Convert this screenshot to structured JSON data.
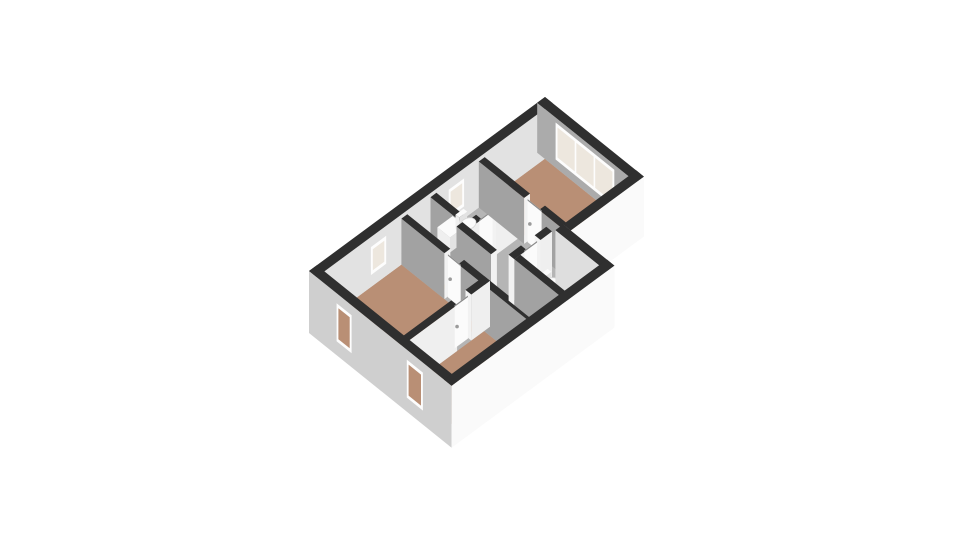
{
  "meta": {
    "description": "3D isometric floor plan of an upper storey with three brown-floored rooms, a bathroom, hallway, WC and staircase",
    "background": "#ffffff"
  },
  "palette": {
    "wall_top": "#2f2f2f",
    "interior_face_se": "#efefef",
    "interior_face_sw": "#a2a2a2",
    "nw_interior_face": "#e2e2e2",
    "ne_interior_face": "#ababab",
    "exterior_face_sw": "#cfcfcf",
    "exterior_face_se": "#fafafa",
    "cap_face": "#f2f2f2",
    "floor_gray": "#b5b5b5",
    "floor_brown": "#b98f75",
    "window_frame": "#fdfdfd",
    "window_pane": "#ede7de",
    "window_pane_exterior": "#b98f75",
    "door_leaf": "#fbfbfb",
    "door_top": "#8a8a8a",
    "door_handle": "#9b9b9b",
    "stairs": "#dfa04e",
    "stairs_step": "#f2c684",
    "fixture_top": "#fbfbfb",
    "fixture_front": "#e3e3e3",
    "fixture_side": "#efefef"
  },
  "scene": {
    "projection": {
      "origin": [
        309,
        321
      ],
      "axisU": [
        23.6,
        -17.4
      ],
      "axisV": [
        23.0,
        18.5
      ]
    },
    "elements": [
      {
        "t": "floor",
        "name": "floor-base-gray",
        "fill": "#b5b5b5",
        "pts": [
          [
            0.33,
            0.33
          ],
          [
            9.67,
            0.33
          ],
          [
            9.67,
            3.97
          ],
          [
            6.57,
            3.97
          ],
          [
            6.57,
            5.87
          ],
          [
            0.33,
            5.87
          ]
        ]
      },
      {
        "t": "floor",
        "name": "floor-bedroom-right",
        "fill": "#b98f75",
        "pts": [
          [
            7.125,
            0.33
          ],
          [
            9.67,
            0.33
          ],
          [
            9.67,
            3.97
          ],
          [
            7.125,
            3.97
          ]
        ]
      },
      {
        "t": "floor",
        "name": "floor-room-left",
        "fill": "#b98f75",
        "pts": [
          [
            0.33,
            0.33
          ],
          [
            3.595,
            0.33
          ],
          [
            3.595,
            3.675
          ],
          [
            0.33,
            3.675
          ]
        ]
      },
      {
        "t": "floor",
        "name": "floor-room-bottom",
        "fill": "#b98f75",
        "pts": [
          [
            0.33,
            3.925
          ],
          [
            3.595,
            3.925
          ],
          [
            3.595,
            5.87
          ],
          [
            0.33,
            5.87
          ]
        ]
      },
      {
        "t": "stairs",
        "name": "staircase",
        "u1": 3.95,
        "u2": 4.55,
        "v1": 1.7,
        "v2": 3.2,
        "z": -3,
        "steps": 6,
        "fill": "#dfa04e",
        "stepFill": "#f2c684"
      },
      {
        "t": "wall",
        "name": "wall-exterior-nw",
        "axis": "u",
        "pos": 0.165,
        "th": 0.33,
        "from": 0,
        "to": 10,
        "h": 50,
        "zb": 0,
        "face": "#e2e2e2",
        "cap": false
      },
      {
        "t": "window",
        "name": "window-nw-left-room",
        "axis": "u",
        "pos": 0.33,
        "a": 2.3,
        "b": 2.95,
        "z1": 12,
        "z2": 40,
        "panes": 1,
        "pane": "#ede7de"
      },
      {
        "t": "window",
        "name": "window-nw-bathroom",
        "axis": "u",
        "pos": 0.33,
        "a": 5.6,
        "b": 6.25,
        "z1": 12,
        "z2": 40,
        "panes": 1,
        "pane": "#ede7de"
      },
      {
        "t": "wall",
        "name": "wall-exterior-ne",
        "axis": "v",
        "pos": 9.835,
        "th": 0.33,
        "from": 0,
        "to": 4.3,
        "h": 50,
        "zb": 0,
        "face": "#ababab",
        "cap": true
      },
      {
        "t": "window",
        "name": "window-ne-triple",
        "axis": "v",
        "pos": 9.67,
        "a": 0.8,
        "b": 3.35,
        "z1": 8,
        "z2": 45,
        "panes": 3,
        "pane": "#ede7de"
      },
      {
        "t": "wall",
        "name": "wall-bathroom-west",
        "axis": "v",
        "pos": 4.95,
        "th": 0.25,
        "from": 0.33,
        "to": 2.025,
        "h": 46,
        "face": "#a2a2a2",
        "cap": true
      },
      {
        "t": "wall",
        "name": "wall-bathroom-south",
        "axis": "u",
        "pos": 1.9,
        "th": 0.25,
        "from": 4.825,
        "to": 6.875,
        "h": 46,
        "face": "#efefef",
        "cap": true,
        "gaps": [
          [
            5.35,
            5.95
          ]
        ]
      },
      {
        "t": "door",
        "name": "door-bathroom",
        "axis": "u",
        "pos": 1.9,
        "a": 5.37,
        "b": 5.93,
        "h": 43
      },
      {
        "t": "box",
        "name": "sink-vanity",
        "u1": 5.0,
        "u2": 5.65,
        "v1": 0.45,
        "v2": 1.0,
        "h": 15
      },
      {
        "t": "box",
        "name": "toilet-tank-bathroom",
        "u1": 5.78,
        "u2": 6.12,
        "v1": 0.44,
        "v2": 0.6,
        "h": 14
      },
      {
        "t": "bowl",
        "name": "toilet-bathroom",
        "cu": 5.95,
        "cv": 0.82,
        "r": 0.26,
        "z": 9
      },
      {
        "t": "wall",
        "name": "wall-bedroom-right-west",
        "axis": "v",
        "pos": 7.0,
        "th": 0.25,
        "from": 0.33,
        "to": 3.97,
        "h": 46,
        "face": "#a2a2a2",
        "cap": true,
        "gaps": [
          [
            2.3,
            2.95
          ]
        ]
      },
      {
        "t": "door",
        "name": "door-bedroom-right",
        "axis": "v",
        "pos": 7.0,
        "a": 2.32,
        "b": 2.93,
        "h": 43
      },
      {
        "t": "wall",
        "name": "wall-exterior-se-upper",
        "axis": "u",
        "pos": 4.135,
        "th": 0.33,
        "from": 6.9,
        "to": 10,
        "h": 50,
        "zb": -10,
        "face": "#fafafa",
        "cap": true
      },
      {
        "t": "wall",
        "name": "wall-stairwell",
        "axis": "v",
        "pos": 4.72,
        "th": 0.25,
        "from": 1.7,
        "to": 3.2,
        "h": 46,
        "face": "#a2a2a2",
        "cap": true
      },
      {
        "t": "wall",
        "name": "wall-hall-west",
        "axis": "v",
        "pos": 3.72,
        "th": 0.25,
        "from": 0.33,
        "to": 5.87,
        "h": 46,
        "face": "#a2a2a2",
        "cap": true,
        "gaps": [
          [
            2.2,
            2.8
          ]
        ]
      },
      {
        "t": "door",
        "name": "door-hall",
        "axis": "v",
        "pos": 3.72,
        "a": 2.22,
        "b": 2.78,
        "h": 43
      },
      {
        "t": "wall",
        "name": "wall-wc-north",
        "axis": "u",
        "pos": 3.7,
        "th": 0.25,
        "from": 4.975,
        "to": 6.57,
        "h": 46,
        "face": "#efefef",
        "cap": true,
        "gaps": [
          [
            5.5,
            6.08
          ]
        ]
      },
      {
        "t": "door",
        "name": "door-wc",
        "axis": "u",
        "pos": 3.7,
        "a": 5.52,
        "b": 6.06,
        "h": 43
      },
      {
        "t": "box",
        "name": "toilet-tank-wc",
        "u1": 5.98,
        "u2": 6.35,
        "v1": 3.86,
        "v2": 4.02,
        "h": 13
      },
      {
        "t": "bowl",
        "name": "toilet-wc",
        "cu": 6.15,
        "cv": 4.22,
        "r": 0.24,
        "z": 9
      },
      {
        "t": "wall",
        "name": "wall-exterior-ne-lower",
        "axis": "v",
        "pos": 6.735,
        "th": 0.33,
        "from": 3.97,
        "to": 6.2,
        "h": 50,
        "zb": -10,
        "face": "#dedede",
        "cap": true
      },
      {
        "t": "wall",
        "name": "wall-wc-west",
        "axis": "v",
        "pos": 5.1,
        "th": 0.25,
        "from": 3.825,
        "to": 5.87,
        "h": 46,
        "face": "#a2a2a2",
        "cap": true
      },
      {
        "t": "wall",
        "name": "wall-rooms-divider",
        "axis": "u",
        "pos": 3.8,
        "th": 0.25,
        "from": 0.33,
        "to": 3.845,
        "h": 46,
        "face": "#efefef",
        "cap": true,
        "gaps": [
          [
            2.45,
            3.05
          ]
        ]
      },
      {
        "t": "door",
        "name": "door-room-bottom",
        "axis": "u",
        "pos": 3.8,
        "a": 2.47,
        "b": 3.03,
        "h": 43
      },
      {
        "t": "wall",
        "name": "wall-exterior-sw",
        "axis": "v",
        "pos": 0.165,
        "th": 0.33,
        "from": 0,
        "to": 6.2,
        "h": 50,
        "zb": -12,
        "face": "#cfcfcf",
        "cap": false
      },
      {
        "t": "window",
        "name": "window-sw-left-room",
        "axis": "v",
        "pos": 0,
        "a": 1.2,
        "b": 1.85,
        "z1": 2,
        "z2": 40,
        "panes": 1,
        "pane": "#b98f75"
      },
      {
        "t": "window",
        "name": "window-sw-bottom-room",
        "axis": "v",
        "pos": 0,
        "a": 4.25,
        "b": 4.95,
        "z1": 2,
        "z2": 40,
        "panes": 1,
        "pane": "#b98f75"
      },
      {
        "t": "wall",
        "name": "wall-exterior-se-lower",
        "axis": "u",
        "pos": 6.035,
        "th": 0.33,
        "from": 0,
        "to": 6.9,
        "h": 50,
        "zb": -12,
        "face": "#fafafa",
        "cap": false
      }
    ]
  }
}
